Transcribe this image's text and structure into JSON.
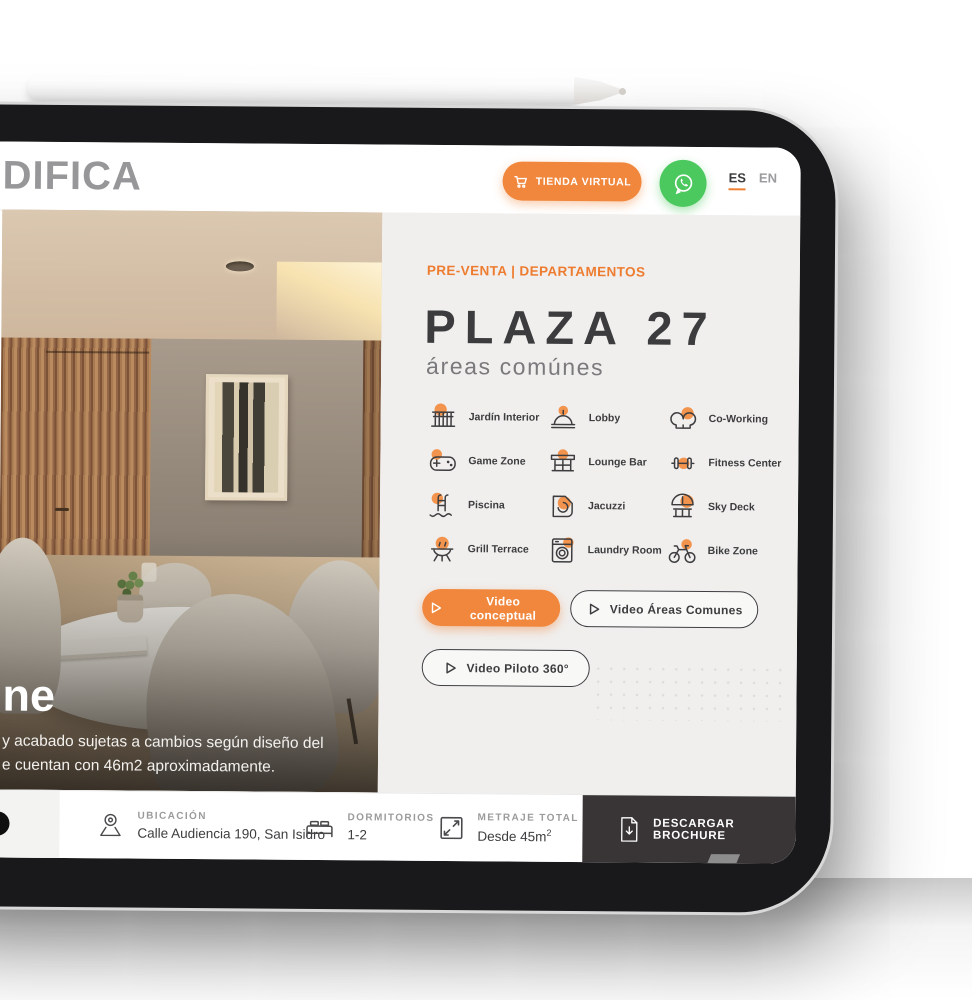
{
  "header": {
    "logo": "DIFICA",
    "store_button": "TIENDA VIRTUAL",
    "lang_es": "ES",
    "lang_en": "EN"
  },
  "panel": {
    "eyebrow": "PRE-VENTA | DEPARTAMENTOS",
    "title": "PLAZA 27",
    "subtitle": "áreas comúnes",
    "amenities": [
      {
        "label": "Jardín Interior",
        "icon": "garden-icon"
      },
      {
        "label": "Lobby",
        "icon": "reception-bell-icon"
      },
      {
        "label": "Co-Working",
        "icon": "coworking-heads-icon"
      },
      {
        "label": "Game Zone",
        "icon": "gamepad-icon"
      },
      {
        "label": "Lounge Bar",
        "icon": "lounge-bar-icon"
      },
      {
        "label": "Fitness Center",
        "icon": "dumbbell-icon"
      },
      {
        "label": "Piscina",
        "icon": "pool-ladder-icon"
      },
      {
        "label": "Jacuzzi",
        "icon": "jacuzzi-icon"
      },
      {
        "label": "Sky Deck",
        "icon": "umbrella-deck-icon"
      },
      {
        "label": "Grill Terrace",
        "icon": "grill-icon"
      },
      {
        "label": "Laundry Room",
        "icon": "washing-machine-icon"
      },
      {
        "label": "Bike Zone",
        "icon": "bicycle-icon"
      }
    ],
    "videos": {
      "conceptual": "Video conceptual",
      "areas": "Video Áreas Comunes",
      "piloto": "Video Piloto 360°"
    }
  },
  "photo": {
    "heading_fragment": "ne",
    "line1": "y acabado sujetas a cambios según diseño del",
    "line2": "e cuentan con 46m2 aproximadamente."
  },
  "infobar": {
    "ubicacion": {
      "label": "UBICACIÓN",
      "value": "Calle Audiencia 190, San Isidro"
    },
    "dormitorios": {
      "label": "DORMITORIOS",
      "value": "1-2"
    },
    "metraje": {
      "label": "METRAJE TOTAL",
      "value": "Desde 45m",
      "sup": "2"
    },
    "brochure_label": "DESCARGAR BROCHURE"
  },
  "colors": {
    "accent_orange": "#EF8033",
    "button_orange": "#F0873D",
    "icon_blob_orange": "#F2944D",
    "whatsapp_green": "#4BC85E",
    "dark_text": "#3D3D3F",
    "logo_gray": "#97979A",
    "panel_bg": "#F0EFEE",
    "brochure_bg": "#393536"
  }
}
